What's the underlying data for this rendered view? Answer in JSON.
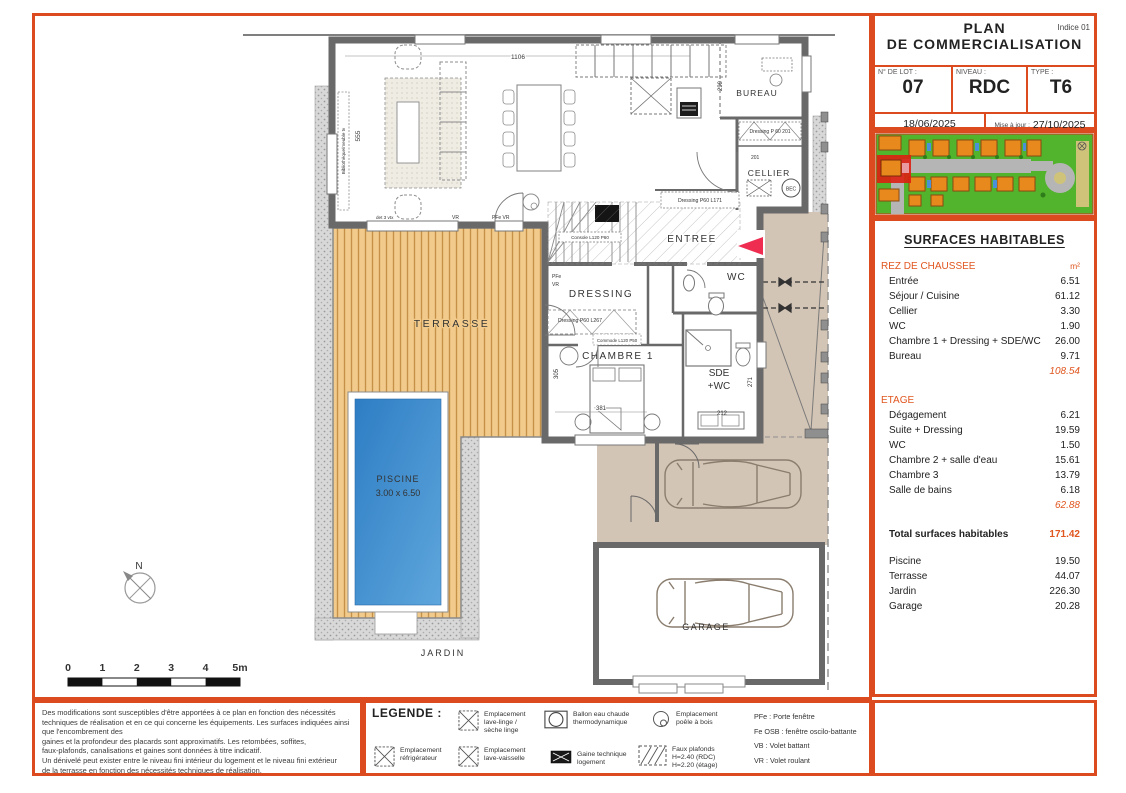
{
  "header": {
    "indice": "Indice 01",
    "title1": "PLAN",
    "title2": "DE COMMERCIALISATION",
    "lot_label": "N° DE LOT :",
    "lot": "07",
    "niveau_label": "NIVEAU :",
    "niveau": "RDC",
    "type_label": "TYPE :",
    "type": "T6",
    "date": "18/06/2025",
    "maj_label": "Mise à jour :",
    "maj": "27/10/2025"
  },
  "surfaces": {
    "title": "SURFACES HABITABLES",
    "unit": "m²",
    "rdc_label": "REZ DE CHAUSSEE",
    "rdc_rows": [
      {
        "label": "Entrée",
        "value": "6.51"
      },
      {
        "label": "Séjour / Cuisine",
        "value": "61.12"
      },
      {
        "label": "Cellier",
        "value": "3.30"
      },
      {
        "label": "WC",
        "value": "1.90"
      },
      {
        "label": "Chambre 1 + Dressing + SDE/WC",
        "value": "26.00"
      },
      {
        "label": "Bureau",
        "value": "9.71"
      }
    ],
    "rdc_total": "108.54",
    "etage_label": "ETAGE",
    "etage_rows": [
      {
        "label": "Dégagement",
        "value": "6.21"
      },
      {
        "label": "Suite + Dressing",
        "value": "19.59"
      },
      {
        "label": "WC",
        "value": "1.50"
      },
      {
        "label": "Chambre 2 + salle d'eau",
        "value": "15.61"
      },
      {
        "label": "Chambre 3",
        "value": "13.79"
      },
      {
        "label": "Salle de bains",
        "value": "6.18"
      }
    ],
    "etage_total": "62.88",
    "total_label": "Total surfaces habitables",
    "total_value": "171.42",
    "extra_rows": [
      {
        "label": "Piscine",
        "value": "19.50"
      },
      {
        "label": "Terrasse",
        "value": "44.07"
      },
      {
        "label": "Jardin",
        "value": "226.30"
      },
      {
        "label": "Garage",
        "value": "20.28"
      }
    ]
  },
  "plan": {
    "rooms": {
      "bureau": "BUREAU",
      "cellier": "CELLIER",
      "entree": "ENTREE",
      "wc": "WC",
      "dressing": "DRESSING",
      "chambre1": "CHAMBRE 1",
      "sde1": "SDE",
      "sde2": "+WC",
      "terrasse": "TERRASSE",
      "piscine": "PISCINE",
      "piscine_dim": "3.00 x 6.50",
      "jardin": "JARDIN",
      "garage": "GARAGE"
    },
    "ann": {
      "bec": "BEC",
      "dressing201": "Dressing P 60 201",
      "n201": "201",
      "l171": "Dressing P60 L171",
      "l267": "Dressing P60 L267",
      "console": "Console L120 P60",
      "commode": "Commode L120 P50",
      "biblio": "Bibliothèque/meuble tv",
      "pfe": "PFe",
      "vr": "VR",
      "pfevr": "PFe VR",
      "vtx": "det 3 vtx",
      "north": "N"
    },
    "dims": {
      "d1106": "1106",
      "d555": "555",
      "d299": "299",
      "d381": "381",
      "d305": "305",
      "d212": "212",
      "d271": "271"
    },
    "scale": [
      "0",
      "1",
      "2",
      "3",
      "4",
      "5m"
    ]
  },
  "disclaimer": {
    "lines": [
      "Des modifications sont susceptibles d'être apportées à ce plan en fonction des nécessités",
      "techniques de réalisation et en ce qui concerne les équipements. Les surfaces indiquées ainsi",
      "que l'encombrement des",
      "gaines et la profondeur des placards sont approximatifs. Les retombées, soffites,",
      "faux-plafonds, canalisations et gaines sont données à titre indicatif.",
      "Un dénivelé peut exister entre le niveau fini intérieur du logement et le niveau fini extérieur",
      "de la terrasse en fonction des nécessités techniques de réalisation."
    ]
  },
  "legend": {
    "title": "LEGENDE :",
    "items": [
      {
        "lines": [
          "Emplacement",
          "lave-linge /",
          "sèche linge"
        ]
      },
      {
        "lines": [
          "Ballon eau chaude",
          "thermodynamique"
        ]
      },
      {
        "lines": [
          "Emplacement",
          "poêle à bois"
        ]
      },
      {
        "lines": [
          "Emplacement",
          "réfrigérateur"
        ]
      },
      {
        "lines": [
          "Emplacement",
          "lave-vaisselle"
        ]
      },
      {
        "lines": [
          "Gaine technique",
          "logement"
        ]
      },
      {
        "lines": [
          "Faux plafonds",
          "H=2.40 (RDC)",
          "H=2.20 (étage)"
        ]
      }
    ],
    "abbr": [
      "PFe : Porte fenêtre",
      "Fe OSB : fenêtre oscilo-battante",
      "VB : Volet battant",
      "VR : Volet roulant"
    ]
  },
  "colors": {
    "frame": "#dc4a1f",
    "accent": "#e0561f",
    "pool": "#3485cb",
    "deck": "#f2cb8c",
    "driveway": "#d3c5b5",
    "wall": "#696969",
    "arrow": "#ee2d50"
  }
}
